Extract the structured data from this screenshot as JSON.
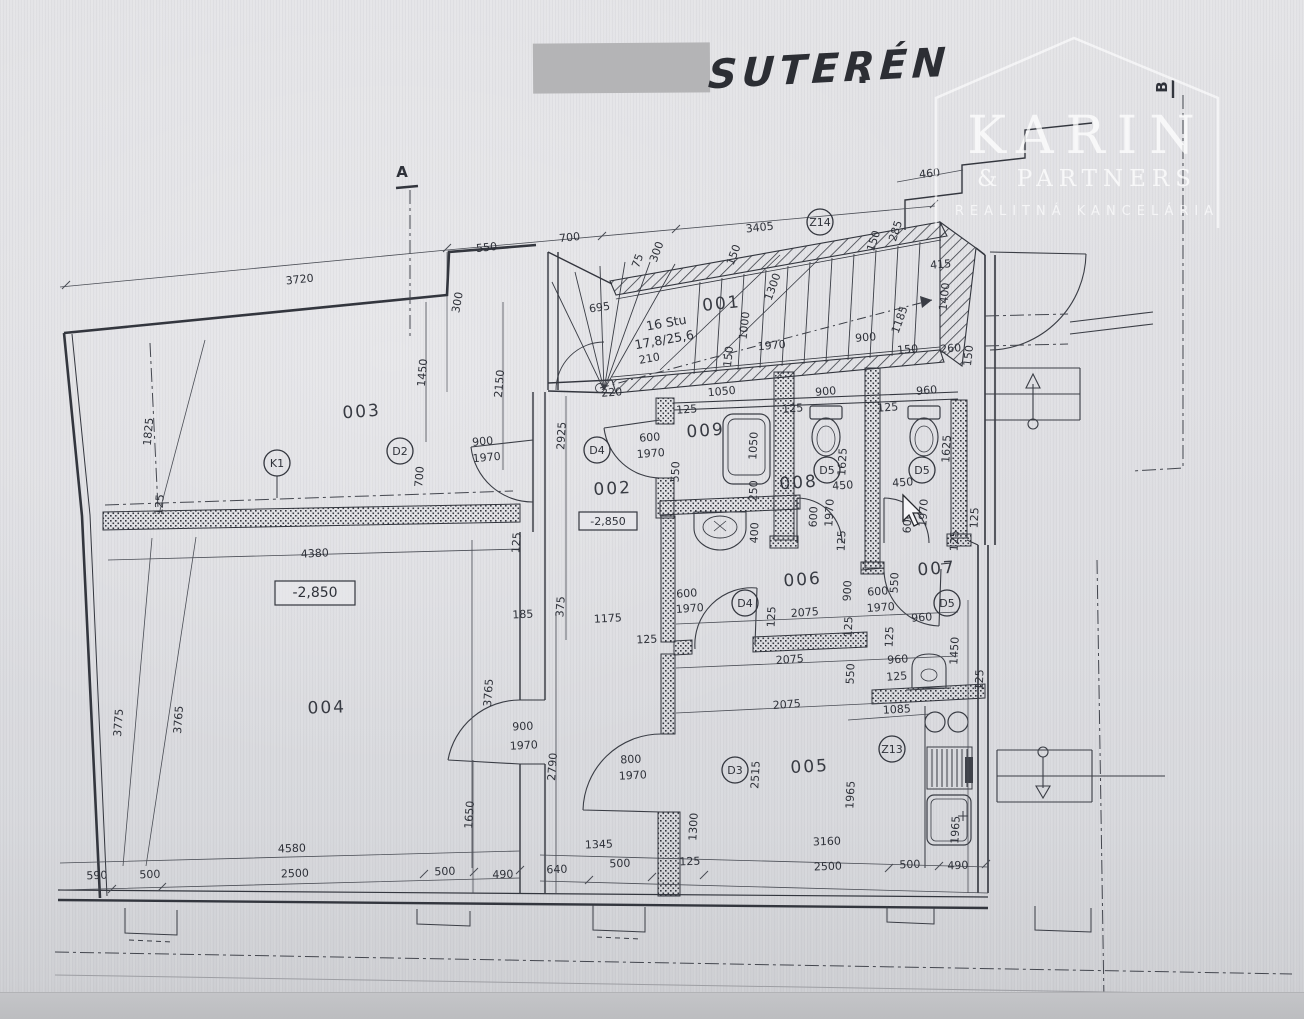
{
  "sheet": {
    "title": "SUTERÉN",
    "dot": ".",
    "redacted_area": "redacted-label"
  },
  "watermark": {
    "brand": "KARIN",
    "sub": "& PARTNERS",
    "tagline": "REALITNÁ KANCELÁRIA"
  },
  "plan": {
    "room_labels": [
      {
        "t": "001",
        "x": 722,
        "y": 309,
        "r": -6
      },
      {
        "t": "002",
        "x": 613,
        "y": 494,
        "r": -3
      },
      {
        "t": "003",
        "x": 362,
        "y": 417,
        "r": -4
      },
      {
        "t": "004",
        "x": 327,
        "y": 713,
        "r": -2
      },
      {
        "t": "005",
        "x": 810,
        "y": 772,
        "r": -3
      },
      {
        "t": "006",
        "x": 803,
        "y": 585,
        "r": -4
      },
      {
        "t": "007",
        "x": 937,
        "y": 574,
        "r": -4
      },
      {
        "t": "008",
        "x": 799,
        "y": 488,
        "r": -4
      },
      {
        "t": "009",
        "x": 706,
        "y": 436,
        "r": -4
      }
    ],
    "stair_note": [
      {
        "t": "16 Stu",
        "x": 667,
        "y": 327,
        "r": -10
      },
      {
        "t": "17,8/25,6",
        "x": 665,
        "y": 344,
        "r": -10
      }
    ],
    "door_tags": [
      {
        "t": "K1",
        "x": 277,
        "y": 463
      },
      {
        "t": "D2",
        "x": 400,
        "y": 451
      },
      {
        "t": "D4",
        "x": 597,
        "y": 450
      },
      {
        "t": "D4",
        "x": 745,
        "y": 603
      },
      {
        "t": "D3",
        "x": 735,
        "y": 770
      },
      {
        "t": "D5",
        "x": 827,
        "y": 470
      },
      {
        "t": "D5",
        "x": 922,
        "y": 470
      },
      {
        "t": "D5",
        "x": 947,
        "y": 603
      },
      {
        "t": "Z14",
        "x": 820,
        "y": 222
      },
      {
        "t": "Z13",
        "x": 892,
        "y": 749
      }
    ],
    "elevation_boxes": [
      {
        "t": "-2,850",
        "x": 608,
        "y": 521,
        "w": 58,
        "h": 18,
        "fs": 11
      },
      {
        "t": "-2,850",
        "x": 315,
        "y": 593,
        "w": 80,
        "h": 24,
        "fs": 14
      }
    ],
    "section_markers": [
      {
        "t": "A",
        "x": 402,
        "y": 177,
        "r": 0
      },
      {
        "t": "B",
        "x": 1167,
        "y": 87,
        "r": -90
      }
    ],
    "fixtures": [
      "bathtub",
      "washbasin",
      "toilet",
      "toilet",
      "urinal",
      "stove-burners",
      "radiator",
      "kitchen-sink",
      "stairs-up-arrow",
      "stairs-down-arrow",
      "winder-staircase"
    ],
    "dimensions": [
      {
        "t": "3720",
        "x": 300,
        "y": 283,
        "r": -6
      },
      {
        "t": "550",
        "x": 487,
        "y": 251,
        "r": -6
      },
      {
        "t": "700",
        "x": 570,
        "y": 241,
        "r": -6
      },
      {
        "t": "3405",
        "x": 760,
        "y": 231,
        "r": -6
      },
      {
        "t": "460",
        "x": 930,
        "y": 177,
        "r": -6
      },
      {
        "t": "300",
        "x": 660,
        "y": 253,
        "r": -70
      },
      {
        "t": "75",
        "x": 641,
        "y": 262,
        "r": -70
      },
      {
        "t": "150",
        "x": 737,
        "y": 256,
        "r": -70
      },
      {
        "t": "285",
        "x": 899,
        "y": 232,
        "r": -72
      },
      {
        "t": "150",
        "x": 877,
        "y": 242,
        "r": -72
      },
      {
        "t": "1300",
        "x": 776,
        "y": 288,
        "r": -70
      },
      {
        "t": "415",
        "x": 941,
        "y": 268,
        "r": -5
      },
      {
        "t": "1400",
        "x": 948,
        "y": 297,
        "r": -84
      },
      {
        "t": "1185",
        "x": 903,
        "y": 321,
        "r": -70
      },
      {
        "t": "1000",
        "x": 748,
        "y": 326,
        "r": -84
      },
      {
        "t": "1970",
        "x": 772,
        "y": 349,
        "r": -5
      },
      {
        "t": "900",
        "x": 866,
        "y": 341,
        "r": -5
      },
      {
        "t": "150",
        "x": 732,
        "y": 357,
        "r": -84
      },
      {
        "t": "150",
        "x": 908,
        "y": 353,
        "r": -5
      },
      {
        "t": "260",
        "x": 951,
        "y": 352,
        "r": -5
      },
      {
        "t": "150",
        "x": 972,
        "y": 356,
        "r": -84
      },
      {
        "t": "695",
        "x": 600,
        "y": 311,
        "r": -8
      },
      {
        "t": "210",
        "x": 650,
        "y": 362,
        "r": -10
      },
      {
        "t": "220",
        "x": 612,
        "y": 396,
        "r": -4
      },
      {
        "t": "1050",
        "x": 722,
        "y": 395,
        "r": -5
      },
      {
        "t": "900",
        "x": 826,
        "y": 395,
        "r": -5
      },
      {
        "t": "960",
        "x": 927,
        "y": 394,
        "r": -5
      },
      {
        "t": "300",
        "x": 461,
        "y": 303,
        "r": -80
      },
      {
        "t": "125",
        "x": 687,
        "y": 413,
        "r": -4
      },
      {
        "t": "125",
        "x": 793,
        "y": 412,
        "r": -4
      },
      {
        "t": "125",
        "x": 888,
        "y": 411,
        "r": -4
      },
      {
        "t": "1050",
        "x": 757,
        "y": 446,
        "r": -87
      },
      {
        "t": "550",
        "x": 679,
        "y": 472,
        "r": -87
      },
      {
        "t": "250",
        "x": 757,
        "y": 491,
        "r": -87
      },
      {
        "t": "400",
        "x": 758,
        "y": 533,
        "r": -87
      },
      {
        "t": "1625",
        "x": 846,
        "y": 462,
        "r": -87
      },
      {
        "t": "1625",
        "x": 950,
        "y": 449,
        "r": -87
      },
      {
        "t": "450",
        "x": 843,
        "y": 489,
        "r": -4
      },
      {
        "t": "450",
        "x": 903,
        "y": 486,
        "r": -4
      },
      {
        "t": "600",
        "x": 817,
        "y": 517,
        "r": -87
      },
      {
        "t": "1970",
        "x": 833,
        "y": 513,
        "r": -87
      },
      {
        "t": "600",
        "x": 911,
        "y": 523,
        "r": -87
      },
      {
        "t": "1970",
        "x": 927,
        "y": 513,
        "r": -87
      },
      {
        "t": "125",
        "x": 845,
        "y": 541,
        "r": -87
      },
      {
        "t": "125",
        "x": 958,
        "y": 541,
        "r": -87
      },
      {
        "t": "125",
        "x": 978,
        "y": 518,
        "r": -87
      },
      {
        "t": "600",
        "x": 650,
        "y": 441,
        "r": -4
      },
      {
        "t": "1970",
        "x": 651,
        "y": 457,
        "r": -4
      },
      {
        "t": "2925",
        "x": 565,
        "y": 436,
        "r": -87
      },
      {
        "t": "1825",
        "x": 152,
        "y": 432,
        "r": -85
      },
      {
        "t": "1450",
        "x": 426,
        "y": 373,
        "r": -85
      },
      {
        "t": "2150",
        "x": 503,
        "y": 384,
        "r": -85
      },
      {
        "t": "900",
        "x": 483,
        "y": 445,
        "r": -5
      },
      {
        "t": "1970",
        "x": 487,
        "y": 461,
        "r": -5
      },
      {
        "t": "700",
        "x": 423,
        "y": 477,
        "r": -85
      },
      {
        "t": "125",
        "x": 163,
        "y": 505,
        "r": -85
      },
      {
        "t": "4380",
        "x": 315,
        "y": 557,
        "r": -3
      },
      {
        "t": "3775",
        "x": 122,
        "y": 723,
        "r": -86
      },
      {
        "t": "3765",
        "x": 182,
        "y": 720,
        "r": -86
      },
      {
        "t": "125",
        "x": 520,
        "y": 543,
        "r": -86
      },
      {
        "t": "185",
        "x": 523,
        "y": 618,
        "r": -3
      },
      {
        "t": "375",
        "x": 564,
        "y": 607,
        "r": -86
      },
      {
        "t": "3765",
        "x": 492,
        "y": 693,
        "r": -86
      },
      {
        "t": "900",
        "x": 523,
        "y": 730,
        "r": -3
      },
      {
        "t": "1970",
        "x": 524,
        "y": 749,
        "r": -3
      },
      {
        "t": "2790",
        "x": 556,
        "y": 767,
        "r": -86
      },
      {
        "t": "1650",
        "x": 473,
        "y": 815,
        "r": -86
      },
      {
        "t": "1175",
        "x": 608,
        "y": 622,
        "r": -3
      },
      {
        "t": "125",
        "x": 647,
        "y": 643,
        "r": -3
      },
      {
        "t": "900",
        "x": 851,
        "y": 591,
        "r": -87
      },
      {
        "t": "550",
        "x": 898,
        "y": 583,
        "r": -87
      },
      {
        "t": "600",
        "x": 878,
        "y": 595,
        "r": -4
      },
      {
        "t": "1970",
        "x": 881,
        "y": 611,
        "r": -4
      },
      {
        "t": "600",
        "x": 687,
        "y": 597,
        "r": -4
      },
      {
        "t": "1970",
        "x": 690,
        "y": 612,
        "r": -4
      },
      {
        "t": "960",
        "x": 922,
        "y": 621,
        "r": -4
      },
      {
        "t": "2075",
        "x": 805,
        "y": 616,
        "r": -4
      },
      {
        "t": "2075",
        "x": 790,
        "y": 663,
        "r": -4
      },
      {
        "t": "2075",
        "x": 787,
        "y": 708,
        "r": -4
      },
      {
        "t": "125",
        "x": 775,
        "y": 617,
        "r": -87
      },
      {
        "t": "125",
        "x": 852,
        "y": 627,
        "r": -87
      },
      {
        "t": "125",
        "x": 893,
        "y": 637,
        "r": -87
      },
      {
        "t": "1450",
        "x": 958,
        "y": 651,
        "r": -87
      },
      {
        "t": "960",
        "x": 898,
        "y": 663,
        "r": -4
      },
      {
        "t": "125",
        "x": 897,
        "y": 680,
        "r": -4
      },
      {
        "t": "125",
        "x": 983,
        "y": 680,
        "r": -87
      },
      {
        "t": "550",
        "x": 854,
        "y": 674,
        "r": -87
      },
      {
        "t": "1085",
        "x": 897,
        "y": 713,
        "r": -3
      },
      {
        "t": "800",
        "x": 631,
        "y": 763,
        "r": -3
      },
      {
        "t": "1970",
        "x": 633,
        "y": 779,
        "r": -3
      },
      {
        "t": "2515",
        "x": 759,
        "y": 775,
        "r": -87
      },
      {
        "t": "1965",
        "x": 854,
        "y": 795,
        "r": -87
      },
      {
        "t": "1300",
        "x": 697,
        "y": 827,
        "r": -87
      },
      {
        "t": "3160",
        "x": 827,
        "y": 845,
        "r": -2
      },
      {
        "t": "1345",
        "x": 599,
        "y": 848,
        "r": -2
      },
      {
        "t": "640",
        "x": 557,
        "y": 873,
        "r": -2
      },
      {
        "t": "500",
        "x": 620,
        "y": 867,
        "r": -2
      },
      {
        "t": "125",
        "x": 690,
        "y": 865,
        "r": -2
      },
      {
        "t": "2500",
        "x": 828,
        "y": 870,
        "r": -2
      },
      {
        "t": "500",
        "x": 910,
        "y": 868,
        "r": -2
      },
      {
        "t": "490",
        "x": 958,
        "y": 869,
        "r": -2
      },
      {
        "t": "1965",
        "x": 959,
        "y": 830,
        "r": -87
      },
      {
        "t": "4580",
        "x": 292,
        "y": 852,
        "r": -2
      },
      {
        "t": "590",
        "x": 97,
        "y": 879,
        "r": -2
      },
      {
        "t": "500",
        "x": 150,
        "y": 878,
        "r": -2
      },
      {
        "t": "2500",
        "x": 295,
        "y": 877,
        "r": -2
      },
      {
        "t": "500",
        "x": 445,
        "y": 875,
        "r": -2
      },
      {
        "t": "490",
        "x": 503,
        "y": 878,
        "r": -2
      }
    ]
  },
  "cursor": {
    "x": 903,
    "y": 495
  }
}
